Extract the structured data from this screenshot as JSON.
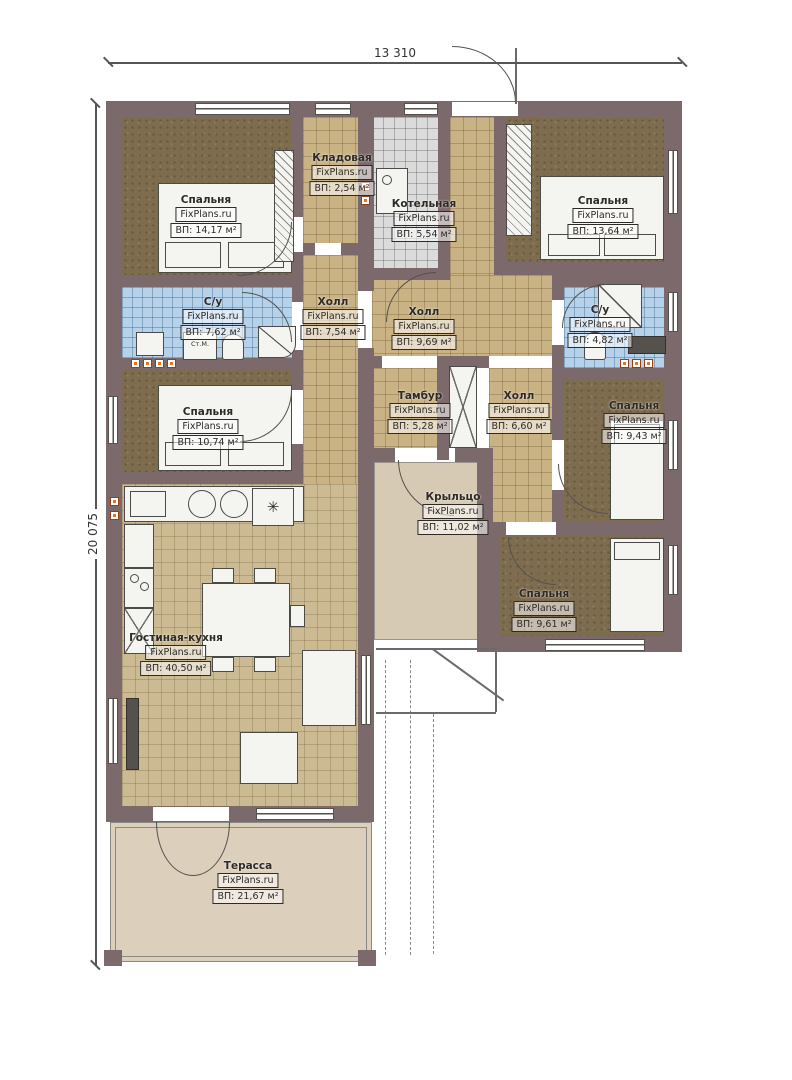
{
  "watermark": "FixPlans.ru",
  "dimensions": {
    "width_label": "13 310",
    "height_label": "20 075"
  },
  "colors": {
    "wall": "#7c696b",
    "bedroom_floor": "#7e6c4f",
    "hall_floor": "#c9b283",
    "bath_floor": "#b5d2ea",
    "boiler_floor": "#dbdbdb",
    "living_floor": "#ccbb92",
    "porch_floor": "#d7cab4",
    "terrace_floor": "#dccfbc",
    "vent_marker": "#e8751c"
  },
  "rooms": [
    {
      "id": "bedroom-top-left",
      "name": "Спальня",
      "area": "ВП: 14,17 м²"
    },
    {
      "id": "storage",
      "name": "Кладовая",
      "area": "ВП: 2,54 м²"
    },
    {
      "id": "boiler-room",
      "name": "Котельная",
      "area": "ВП: 5,54 м²"
    },
    {
      "id": "bedroom-top-right",
      "name": "Спальня",
      "area": "ВП: 13,64 м²"
    },
    {
      "id": "bathroom-left",
      "name": "С/у",
      "area": "ВП: 7,62 м²"
    },
    {
      "id": "hall-west",
      "name": "Холл",
      "area": "ВП: 7,54 м²"
    },
    {
      "id": "hall-center",
      "name": "Холл",
      "area": "ВП: 9,69 м²"
    },
    {
      "id": "bathroom-right",
      "name": "С/у",
      "area": "ВП: 4,82 м²"
    },
    {
      "id": "bedroom-mid-left",
      "name": "Спальня",
      "area": "ВП: 10,74 м²"
    },
    {
      "id": "tambour",
      "name": "Тамбур",
      "area": "ВП: 5,28 м²"
    },
    {
      "id": "hall-east",
      "name": "Холл",
      "area": "ВП: 6,60 м²"
    },
    {
      "id": "bedroom-right",
      "name": "Спальня",
      "area": "ВП: 9,43 м²"
    },
    {
      "id": "porch",
      "name": "Крыльцо",
      "area": "ВП: 11,02 м²"
    },
    {
      "id": "bedroom-bottom-right",
      "name": "Спальня",
      "area": "ВП: 9,61 м²"
    },
    {
      "id": "living-kitchen",
      "name": "Гостиная-кухня",
      "area": "ВП: 40,50 м²"
    },
    {
      "id": "terrace",
      "name": "Терасса",
      "area": "ВП: 21,67 м²"
    }
  ],
  "labels": {
    "washing_machine": "Ст.М."
  },
  "icons": {
    "fridge": "✳"
  }
}
